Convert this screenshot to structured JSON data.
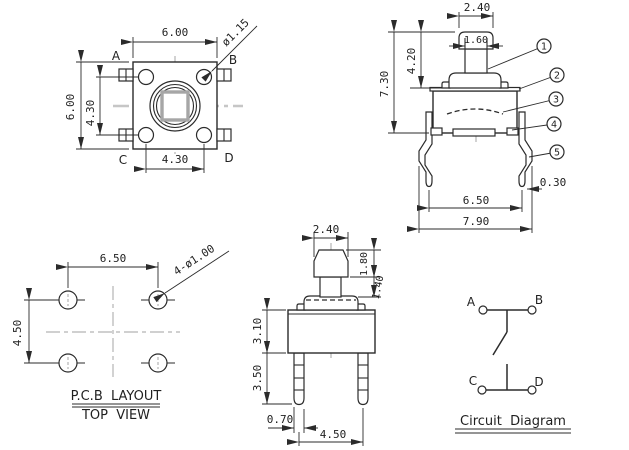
{
  "colors": {
    "line": "#2b2b2b",
    "centerline": "#b3b3b3",
    "background": "#ffffff",
    "text": "#1f1f1f"
  },
  "drawing": {
    "top_view": {
      "dim_body_width": "6.00",
      "dim_body_height": "6.00",
      "dim_pin_pitch_vertical": "4.30",
      "dim_pin_pitch_horizontal": "4.30",
      "dim_pin_diameter": "ø1.15",
      "pin_a": "A",
      "pin_b": "B",
      "pin_c": "C",
      "pin_d": "D"
    },
    "front_view": {
      "dim_cap_width": "2.40",
      "dim_stem_width": "1.60",
      "dim_stem_height": "4.20",
      "dim_total_height": "7.30",
      "dim_leg_span": "6.50",
      "dim_overall_width": "7.90",
      "dim_leg_thickness": "0.30",
      "callouts": [
        "1",
        "2",
        "3",
        "4",
        "5"
      ]
    },
    "pcb_view": {
      "dim_hole_pitch_horizontal": "6.50",
      "dim_hole_pitch_vertical": "4.50",
      "dim_hole_diameter": "4-ø1.00",
      "caption_line1": "P.C.B  LAYOUT",
      "caption_line2": "TOP  VIEW"
    },
    "side_view": {
      "dim_cap_width": "2.40",
      "dim_cap_height": "1.80",
      "dim_stem_height": "1.40",
      "dim_body_height": "3.10",
      "dim_leg_length": "3.50",
      "dim_leg_width": "0.70",
      "dim_leg_pitch": "4.50"
    },
    "circuit_view": {
      "terminal_a": "A",
      "terminal_b": "B",
      "terminal_c": "C",
      "terminal_d": "D",
      "caption": "Circuit  Diagram"
    }
  }
}
